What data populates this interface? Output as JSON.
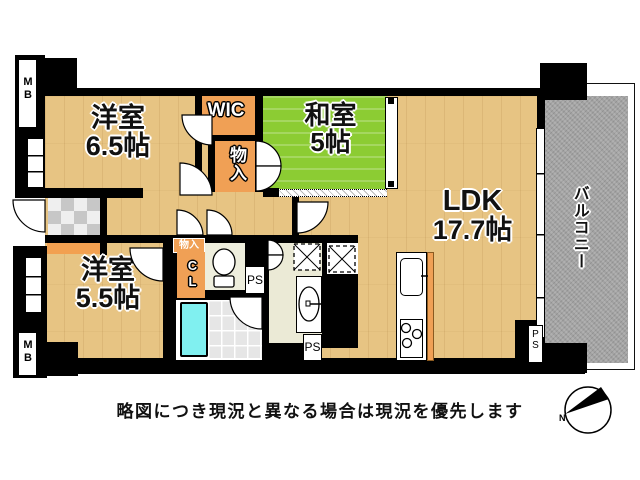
{
  "rooms": {
    "western_room_1": {
      "line1": "洋室",
      "line2": "6.5帖"
    },
    "wic": {
      "label": "WIC"
    },
    "storage_upper": {
      "label": "物入"
    },
    "japanese_room": {
      "line1": "和室",
      "line2": "5帖"
    },
    "ldk": {
      "line1": "LDK",
      "line2": "17.7帖"
    },
    "western_room_2": {
      "line1": "洋室",
      "line2": "5.5帖"
    },
    "balcony": {
      "label": "バルコニー"
    }
  },
  "labels": {
    "mb_top": "MB",
    "mb_bottom": "MB",
    "hall_storage": "物入",
    "closet": "CL",
    "ps_toilet": "PS",
    "ps_washroom": "PS",
    "ps_balcony": "PS",
    "compass_north": "N"
  },
  "disclaimer": "略図につき現況と異なる場合は現況を優先します",
  "colors": {
    "wall": "#000000",
    "wood_floor": "#e7c483",
    "tatami_green": "#8ccc33",
    "closet_orange": "#f0a055",
    "entry_step_orange": "#f2a050",
    "balcony_gray": "#a3a3a3",
    "bathtub_cyan": "#80f0f0"
  }
}
